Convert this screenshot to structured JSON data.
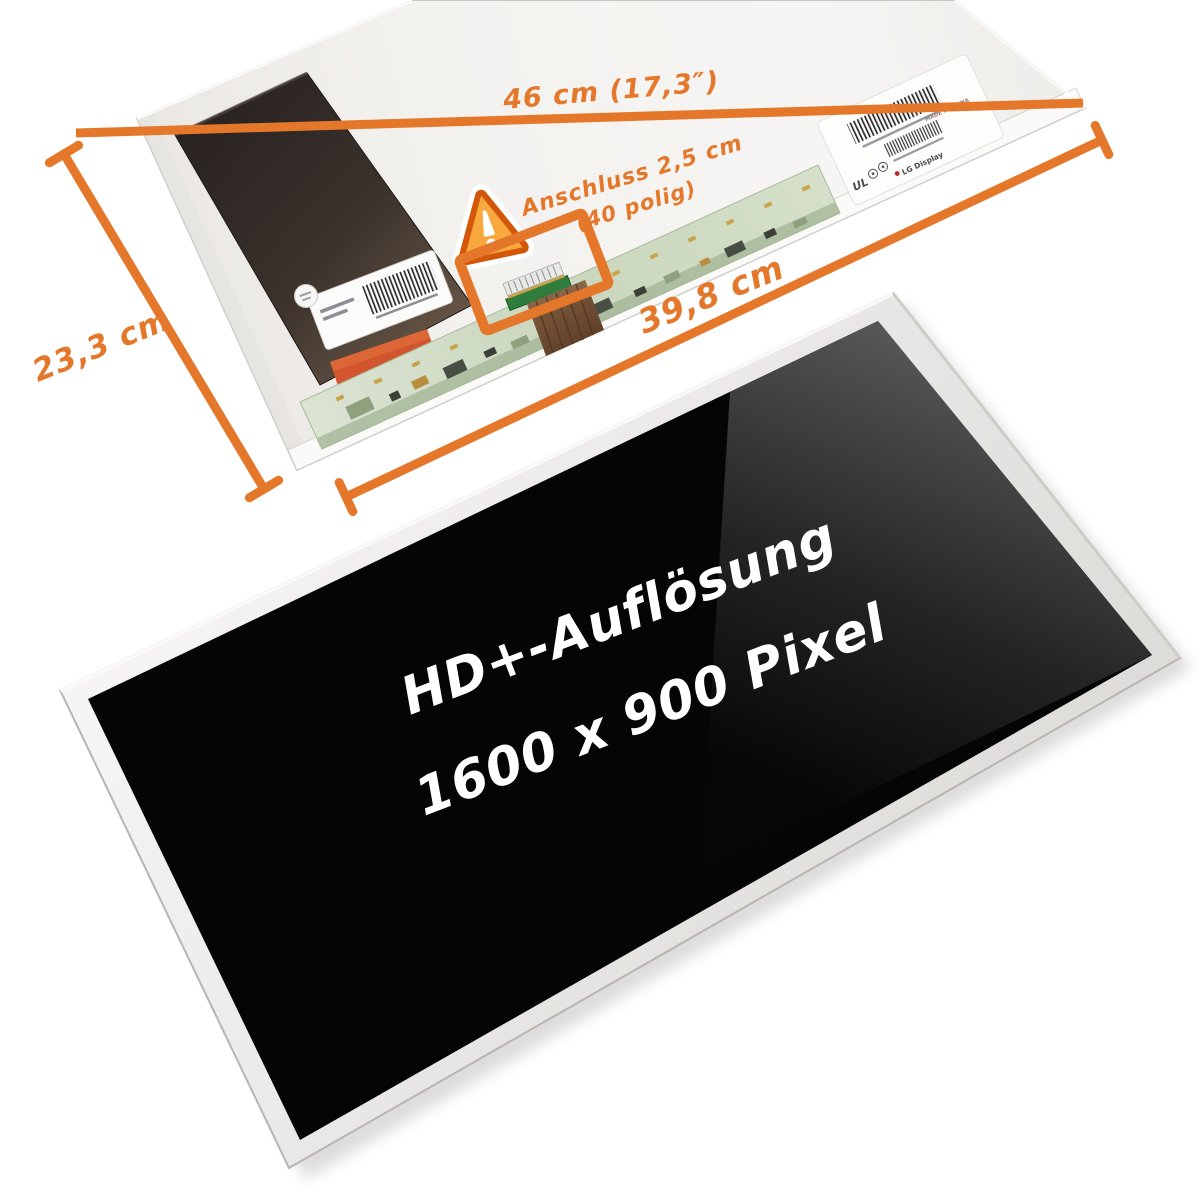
{
  "annotations": {
    "width_label": "46 cm (17,3″)",
    "height_label": "23,3 cm",
    "inner_width_label": "39,8 cm",
    "connector_label_line1": "Anschluss 2,5 cm",
    "connector_label_line2": "(40 polig)"
  },
  "screen_text": {
    "line1": "HD+-Auflösung",
    "line2": "1600 x 900 Pixel"
  },
  "sticker": {
    "cert": "UL",
    "brand": "LG Display",
    "origin": "MADE IN CHINA"
  },
  "colors": {
    "accent_orange": "#E4772A",
    "warning_orange": "#F59A1E",
    "panel_light": "#f3f1ee",
    "dark_cover": "#2a2422",
    "pcb_green": "#cdd8c2",
    "connector_green": "#2f7d3c",
    "ribbon_brown": "#6e4b33",
    "screen_black": "#050505"
  }
}
